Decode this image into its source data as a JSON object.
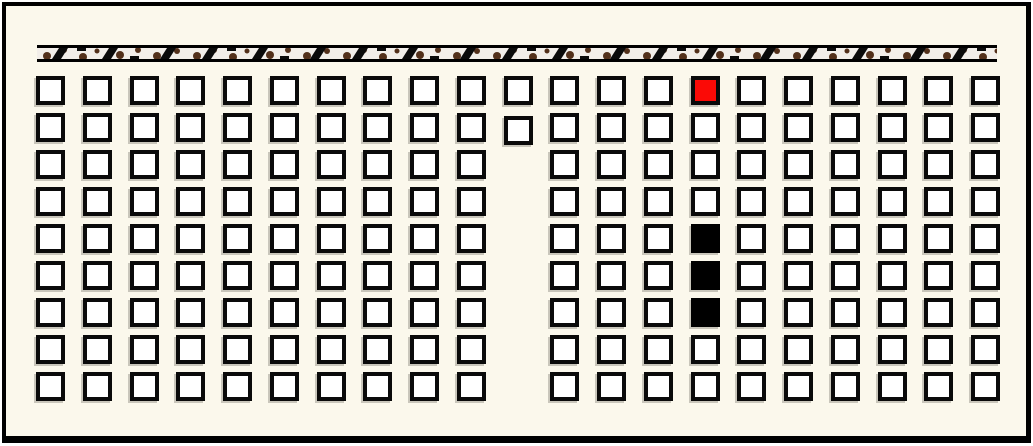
{
  "colors": {
    "background": "#FBF8EC",
    "frame_border": "#000000",
    "cell_fill": "#FFFFFF",
    "cell_border": "#0A0A0A",
    "red_cell": "#FB0A06",
    "black_cell": "#000000",
    "shadow": "#C9C6BB",
    "bar_border": "#000000",
    "bar_background": "#F2EEE9",
    "bar_dot": "#53301B",
    "bar_mark": "#0B0B0B"
  },
  "bar": {
    "x": 37,
    "y": 45,
    "width": 960,
    "height": 17
  },
  "grid": {
    "cols": 21,
    "rows": 9,
    "origin_x": 36,
    "origin_y": 76,
    "pitch_x": 46.75,
    "pitch_y": 37,
    "cell_size": 29,
    "missing_cells": [
      {
        "col": 10,
        "row": 2
      },
      {
        "col": 10,
        "row": 3
      },
      {
        "col": 10,
        "row": 4
      },
      {
        "col": 10,
        "row": 5
      },
      {
        "col": 10,
        "row": 6
      },
      {
        "col": 10,
        "row": 7
      },
      {
        "col": 10,
        "row": 8
      }
    ],
    "offset_cells": [
      {
        "col": 10,
        "row": 1,
        "dy": 3
      }
    ],
    "red_cells": [
      {
        "col": 14,
        "row": 0
      }
    ],
    "black_cells": [
      {
        "col": 14,
        "row": 4
      },
      {
        "col": 14,
        "row": 5
      },
      {
        "col": 14,
        "row": 6
      }
    ]
  }
}
